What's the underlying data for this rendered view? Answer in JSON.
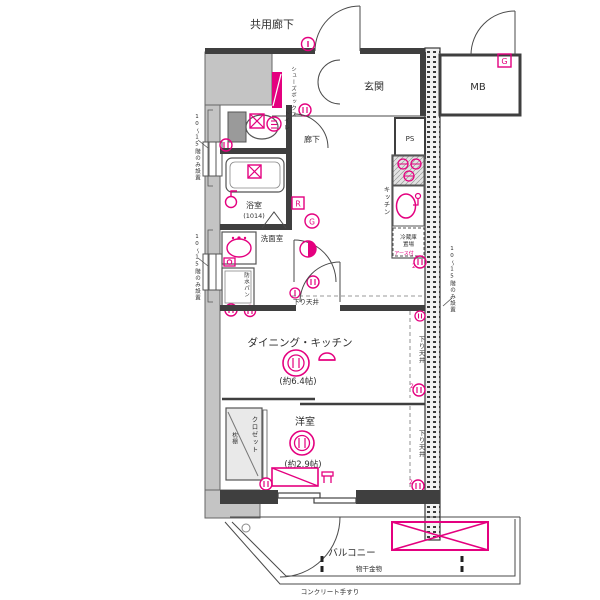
{
  "plan": {
    "title": "apartment-floor-plan",
    "labels": {
      "common_corridor": "共用廊下",
      "entrance": "玄関",
      "meter_box": "MB",
      "pipe_space": "PS",
      "shoe_box": "シューズボックス",
      "toilet": "トイレ",
      "hallway": "廊下",
      "bathroom": "浴室",
      "bathroom_size": "(1014)",
      "washroom": "洗面室",
      "waterproof_pan": "防水パン",
      "kitchen": "キッチン",
      "fridge_l1": "冷蔵庫",
      "fridge_l2": "置場",
      "fridge_note": "アース付",
      "dropped_ceiling": "下り天井",
      "dining_kitchen": "ダイニング・キッチン",
      "dining_kitchen_size": "(約6.4帖)",
      "western_room": "洋室",
      "western_room_size": "(約2.9帖)",
      "closet": "クロゼット",
      "pillow_shelf": "枕棚",
      "balcony": "バルコニー",
      "laundry_fitting": "物干金物",
      "concrete_handrail": "コンクリート手すり",
      "floor_note": "10〜15階のみ設置",
      "outlet_double": "2"
    },
    "badges": {
      "gas_box": "G",
      "gas_circle": "G",
      "remote": "R"
    },
    "colors": {
      "accent": "#E4007F",
      "wall_fill": "#C4C4C4",
      "line": "#4A4A4A"
    }
  }
}
